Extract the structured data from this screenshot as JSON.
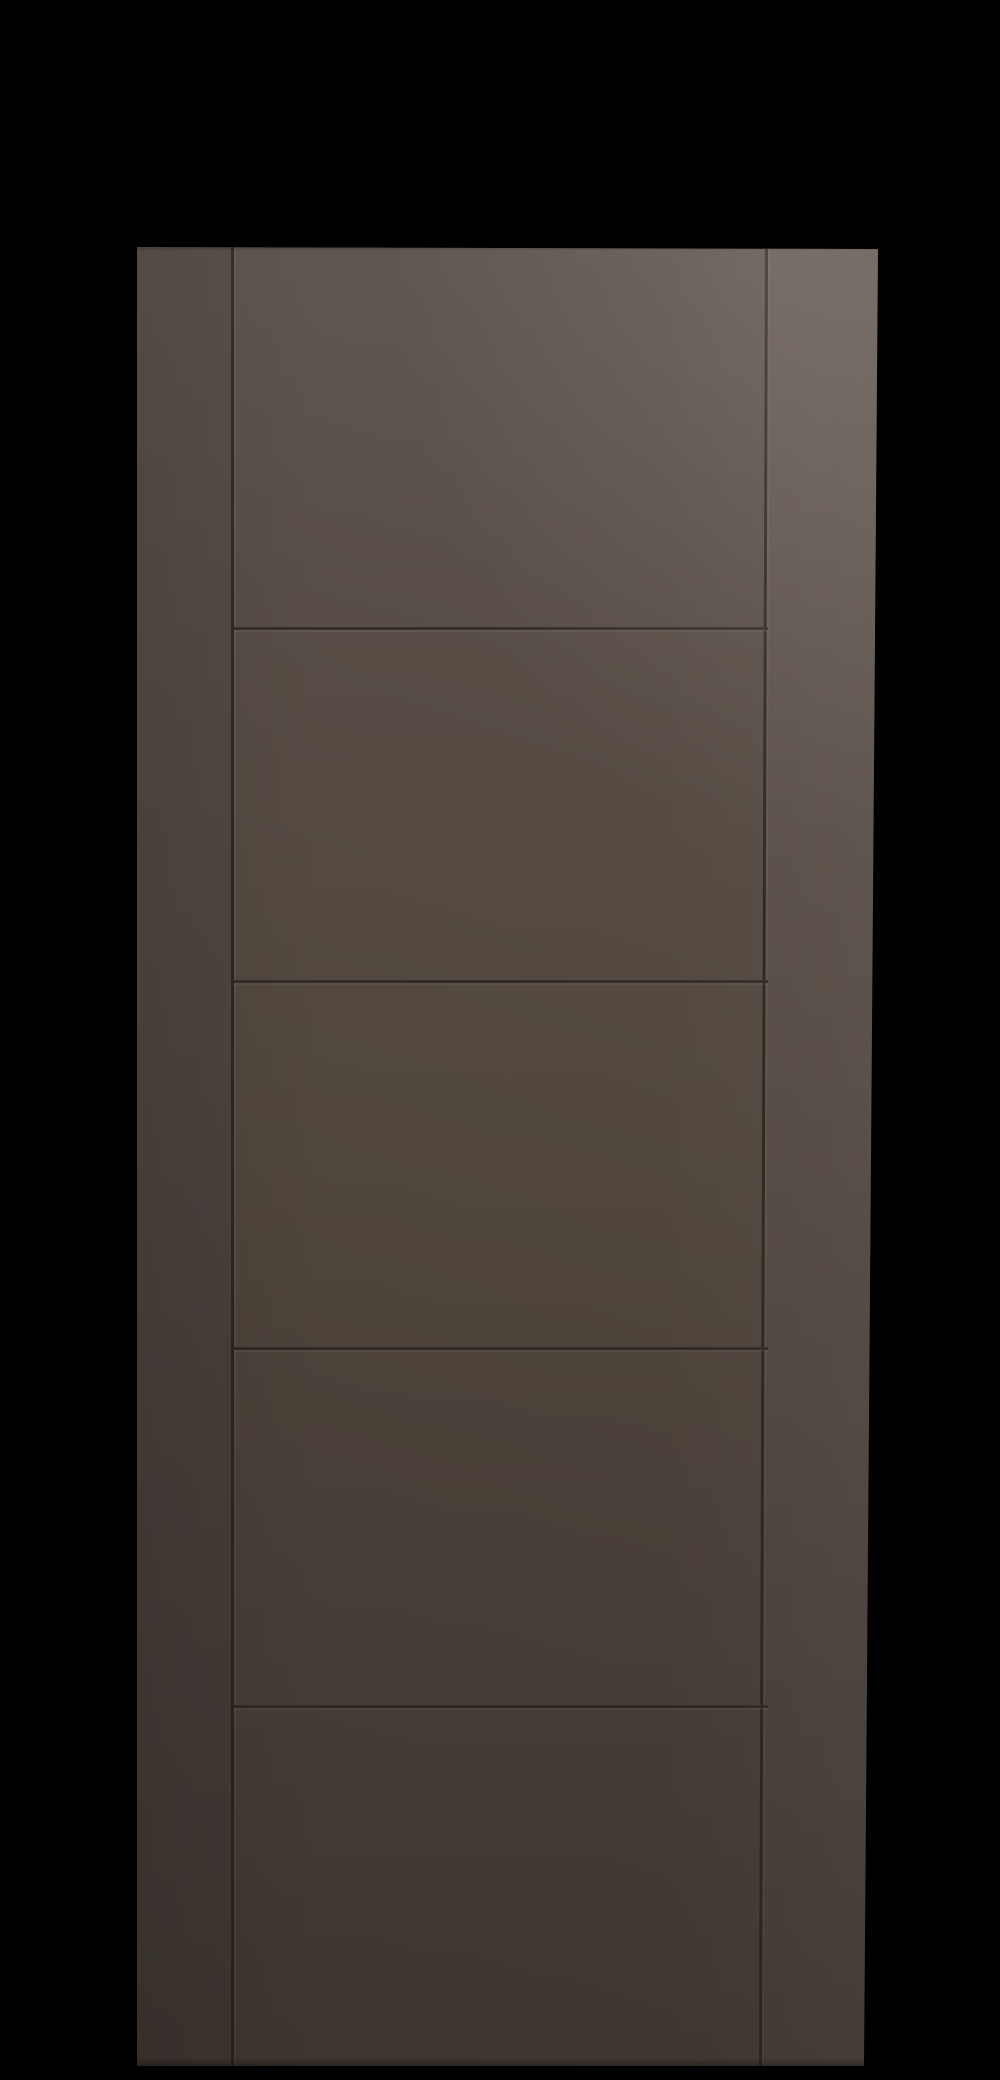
{
  "meta": {
    "type": "product-photo",
    "subject": "modern 5-panel ladder-style interior door slab",
    "finish": "dark chocolate brown, smooth matte",
    "orientation": "upright, front view, slight perspective wider at top"
  },
  "scene": {
    "background": "solid black studio background",
    "door": {
      "panel_count": 5,
      "horizontal_groove_count": 4,
      "vertical_groove_count": 2,
      "stiles": [
        "left-stile",
        "right-stile"
      ],
      "panels": [
        "panel-1",
        "panel-2",
        "panel-3",
        "panel-4",
        "panel-5"
      ],
      "hardware": "none visible",
      "lighting": "soft key light from upper right; bottom-left falls into shadow"
    }
  },
  "palette": {
    "background": "#000000",
    "face-top": "#59504a",
    "face-upper": "#564c45",
    "face-mid": "#53493f",
    "face-lower": "#4e443d",
    "face-bottom": "#483e37",
    "stile-left-top": "#534a44",
    "stile-left-mid": "#4f4540",
    "stile-left-bottom": "#463d37",
    "stile-right-top": "#5e544d",
    "stile-right-mid": "#564c45",
    "stile-right-bottom": "#4a403a",
    "groove": "#2f2822"
  }
}
